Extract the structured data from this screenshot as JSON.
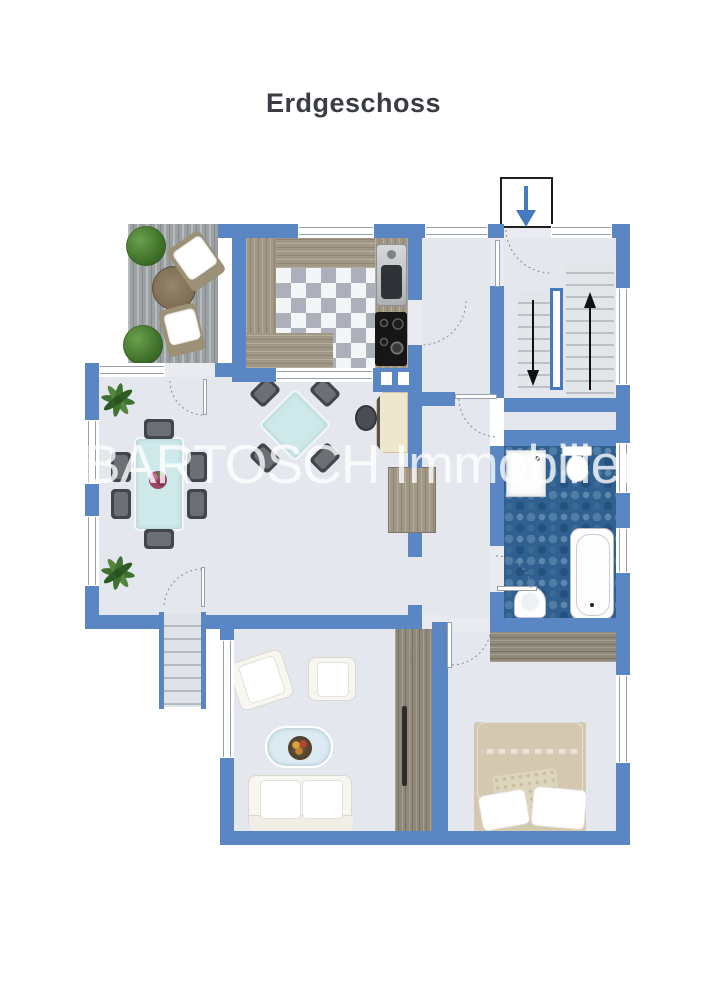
{
  "title": "Erdgeschoss",
  "watermark": "BARTOSCH Immobilien",
  "icons": {
    "entrance": "arrow-down-icon",
    "stairs_up": "arrow-up-icon",
    "stairs_down": "arrow-down-icon",
    "plants": "plant-icon",
    "door_swings": "door-arc-icon"
  },
  "colors": {
    "wall": "#5b86c4",
    "floor": "#e4e7ee",
    "terrace_deck": "#9ba0a2",
    "wood": "#a09784",
    "bath_tile": "#30608f",
    "entrance_arrow": "#4679bd",
    "stair_arrow": "#111111",
    "title_text": "#3a3d42",
    "watermark_text": "rgba(255,255,255,0.78)"
  }
}
